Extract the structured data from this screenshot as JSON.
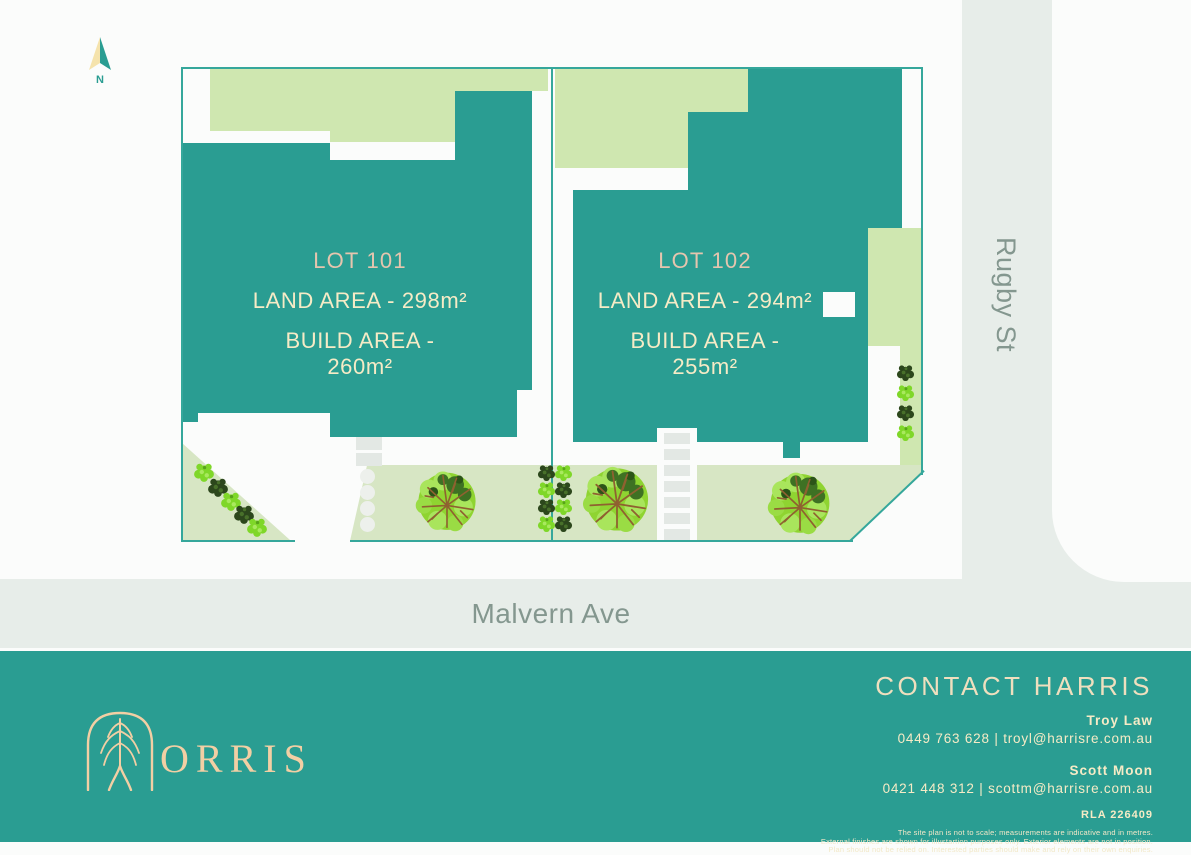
{
  "colors": {
    "page_bg": "#FBFCFB",
    "teal": "#2A9D92",
    "teal_line": "#35A79B",
    "garden": "#CFE7B0",
    "lawn": "#D7E6C4",
    "road": "#E7EDE9",
    "paving": "#E3E8E4",
    "stone": "#EDF0EC",
    "street_text": "#84978F",
    "cream": "#F6EBC6",
    "lot_title": "#E5C5AE",
    "logo_peach": "#F2CFA4",
    "bush_dark": "#2C471C",
    "bush_light": "#7FD729",
    "branch_brown": "#8F6130"
  },
  "compass": {
    "label": "N"
  },
  "lots": [
    {
      "title": "LOT 101",
      "land": "LAND AREA - 298m²",
      "build": "BUILD AREA - 260m²"
    },
    {
      "title": "LOT 102",
      "land": "LAND AREA - 294m²",
      "build": "BUILD AREA - 255m²"
    }
  ],
  "streets": {
    "vertical": "Rugby St",
    "horizontal": "Malvern Ave"
  },
  "footer": {
    "logo": "ORRIS",
    "heading": "CONTACT HARRIS",
    "agents": [
      {
        "name": "Troy Law",
        "contact": "0449 763 628 | troyl@harrisre.com.au"
      },
      {
        "name": "Scott Moon",
        "contact": "0421 448 312 | scottm@harrisre.com.au"
      }
    ],
    "licence": "RLA 226409",
    "disclaimer": [
      "The site plan is not to scale; measurements are indicative and in metres.",
      "External finishes are shown for illustartion purposes only. Exterior elements are not in position.",
      "Plan should not be relied on. Interested parties should make and rely on their own enquiries."
    ]
  }
}
